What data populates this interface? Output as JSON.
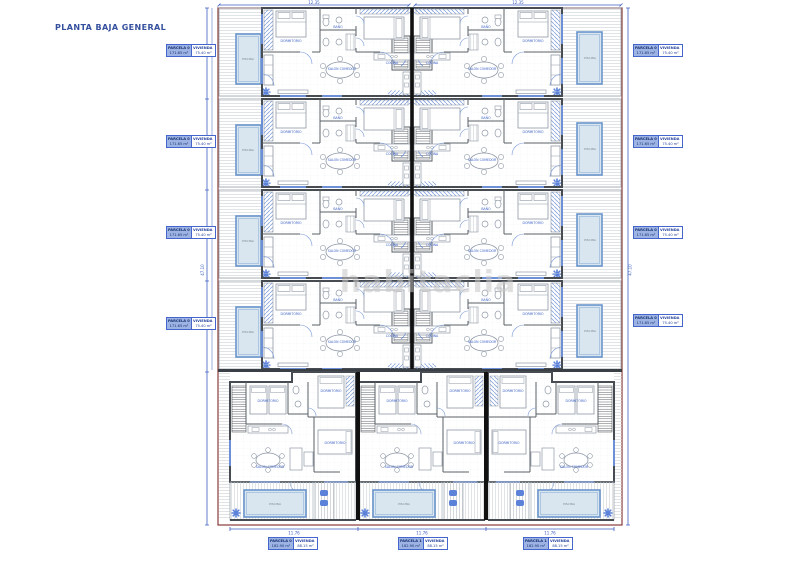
{
  "page": {
    "title": "PLANTA BAJA GENERAL",
    "watermark": "habitaclia"
  },
  "room_labels": {
    "pool": "PISCINA",
    "living": "SALON COMEDOR",
    "kitchen": "COCINA",
    "bedroom": "DORMITORIO",
    "bath": "BAÑO",
    "terrace": "TERRAZA",
    "porch": "PORCHE"
  },
  "dimensions": {
    "top_left": "12.35",
    "top_right": "12.35",
    "left_total": "47.10",
    "right_total": "47.10",
    "bottom": [
      "11.76",
      "11.76",
      "11.76"
    ]
  },
  "parcel_tables": {
    "left": [
      {
        "parcela_label": "PARCELA 01",
        "parcela_value": "171.65 m²",
        "vivienda_label": "VIVIENDA 01",
        "vivienda_value": "75.40 m²"
      },
      {
        "parcela_label": "PARCELA 03",
        "parcela_value": "171.65 m²",
        "vivienda_label": "VIVIENDA 03",
        "vivienda_value": "75.40 m²"
      },
      {
        "parcela_label": "PARCELA 05",
        "parcela_value": "171.65 m²",
        "vivienda_label": "VIVIENDA 05",
        "vivienda_value": "75.40 m²"
      },
      {
        "parcela_label": "PARCELA 07",
        "parcela_value": "171.65 m²",
        "vivienda_label": "VIVIENDA 07",
        "vivienda_value": "75.40 m²"
      }
    ],
    "right": [
      {
        "parcela_label": "PARCELA 02",
        "parcela_value": "171.65 m²",
        "vivienda_label": "VIVIENDA 02",
        "vivienda_value": "75.40 m²"
      },
      {
        "parcela_label": "PARCELA 04",
        "parcela_value": "171.65 m²",
        "vivienda_label": "VIVIENDA 04",
        "vivienda_value": "75.40 m²"
      },
      {
        "parcela_label": "PARCELA 06",
        "parcela_value": "171.65 m²",
        "vivienda_label": "VIVIENDA 06",
        "vivienda_value": "75.40 m²"
      },
      {
        "parcela_label": "PARCELA 08",
        "parcela_value": "171.65 m²",
        "vivienda_label": "VIVIENDA 08",
        "vivienda_value": "75.40 m²"
      }
    ],
    "bottom": [
      {
        "parcela_label": "PARCELA 09",
        "parcela_value": "182.90 m²",
        "vivienda_label": "VIVIENDA 09",
        "vivienda_value": "88.15 m²"
      },
      {
        "parcela_label": "PARCELA 10",
        "parcela_value": "182.90 m²",
        "vivienda_label": "VIVIENDA 10",
        "vivienda_value": "88.15 m²"
      },
      {
        "parcela_label": "PARCELA 11",
        "parcela_value": "182.90 m²",
        "vivienda_label": "VIVIENDA 11",
        "vivienda_value": "88.15 m²"
      }
    ]
  },
  "colors": {
    "accent": "#3c5fc0",
    "pool_fill": "#d9e6f0",
    "pool_border": "#6b95cc",
    "wall": "#474c52",
    "party_wall": "#111111",
    "boundary": "#8a3b3b",
    "hatch": "#ccd1d6",
    "watermark": "#c8c8c8"
  }
}
